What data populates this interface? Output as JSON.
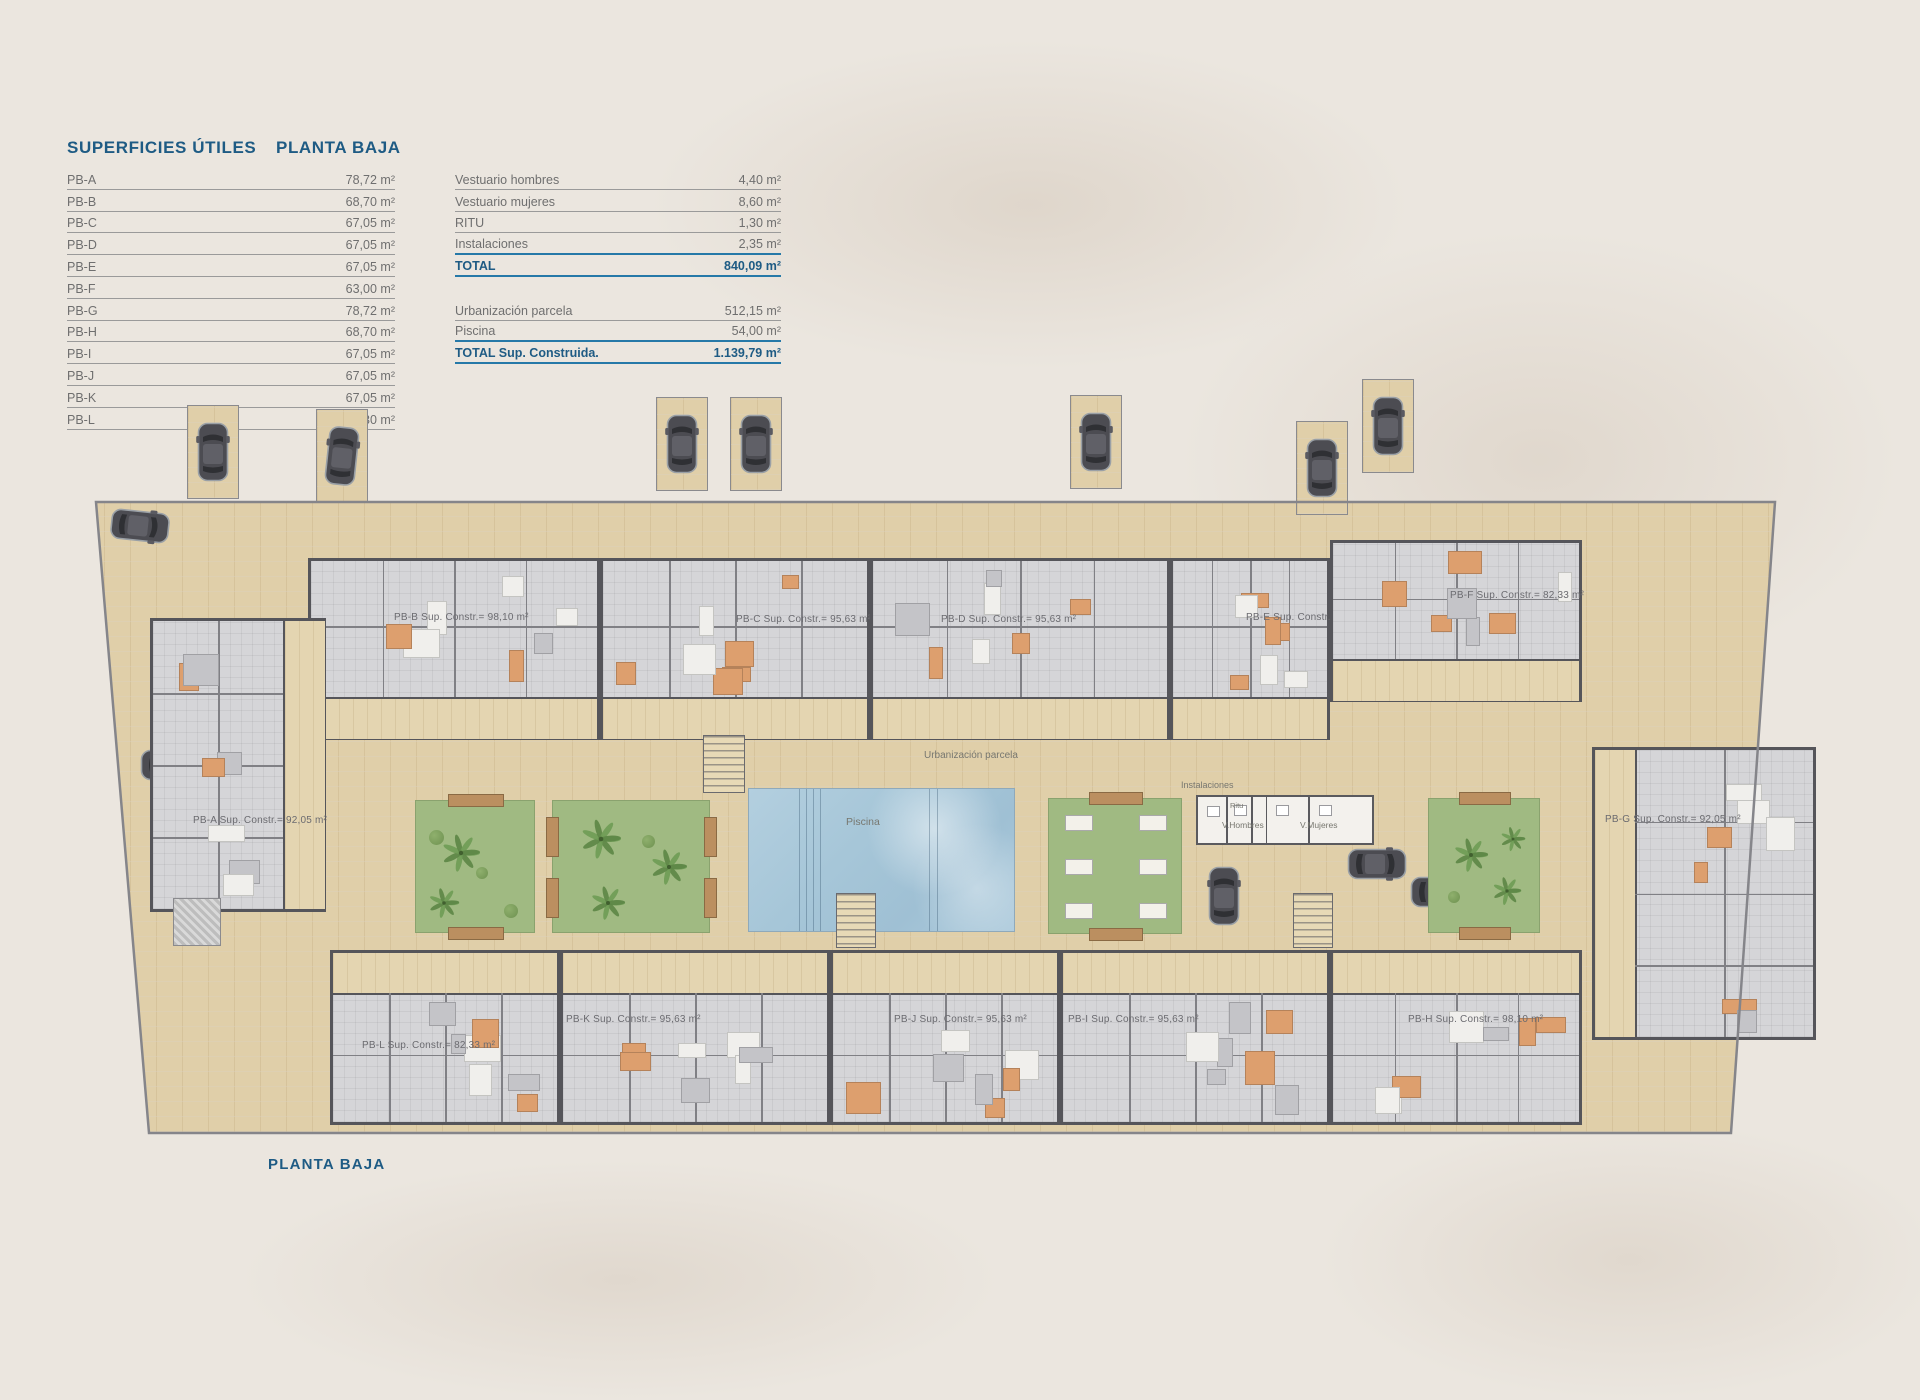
{
  "tables": {
    "title_main": "SUPERFICIES ÚTILES",
    "title_floor": "PLANTA BAJA",
    "unit_rows": [
      {
        "label": "PB-A",
        "value": "78,72 m²"
      },
      {
        "label": "PB-B",
        "value": "68,70 m²"
      },
      {
        "label": "PB-C",
        "value": "67,05 m²"
      },
      {
        "label": "PB-D",
        "value": "67,05 m²"
      },
      {
        "label": "PB-E",
        "value": "67,05 m²"
      },
      {
        "label": "PB-F",
        "value": "63,00 m²"
      },
      {
        "label": "PB-G",
        "value": "78,72 m²"
      },
      {
        "label": "PB-H",
        "value": "68,70 m²"
      },
      {
        "label": "PB-I",
        "value": "67,05 m²"
      },
      {
        "label": "PB-J",
        "value": "67,05 m²"
      },
      {
        "label": "PB-K",
        "value": "67,05 m²"
      },
      {
        "label": "PB-L",
        "value": "63,30 m²"
      }
    ],
    "summary_rows": [
      {
        "label": "Vestuario hombres",
        "value": "4,40 m²"
      },
      {
        "label": "Vestuario mujeres",
        "value": "8,60 m²"
      },
      {
        "label": "RITU",
        "value": "1,30 m²"
      },
      {
        "label": "Instalaciones",
        "value": "2,35 m²",
        "line": "blue"
      },
      {
        "label": "TOTAL",
        "value": "840,09 m²",
        "total": true,
        "line": "blue"
      },
      {
        "spacer": true
      },
      {
        "label": "Urbanización parcela",
        "value": "512,15 m²"
      },
      {
        "label": "Piscina",
        "value": "54,00 m²",
        "line": "blue"
      },
      {
        "label": "TOTAL Sup. Construida.",
        "value": "1.139,79 m²",
        "total": true,
        "line": "blue"
      }
    ]
  },
  "plan": {
    "caption": "PLANTA BAJA",
    "parcel": [
      [
        96,
        502
      ],
      [
        1775,
        502
      ],
      [
        1731,
        1133
      ],
      [
        149,
        1133
      ]
    ],
    "units": [
      {
        "id": "PB-B",
        "label": "PB-B Sup. Constr.= 98,10 m²",
        "x": 308,
        "y": 558,
        "w": 292,
        "h": 182,
        "patio": "bottom",
        "label_x": 394,
        "label_y": 612
      },
      {
        "id": "PB-C",
        "label": "PB-C Sup. Constr.= 95,63 m²",
        "x": 600,
        "y": 558,
        "w": 270,
        "h": 182,
        "patio": "bottom",
        "label_x": 736,
        "label_y": 614
      },
      {
        "id": "PB-D",
        "label": "PB-D Sup. Constr.= 95,63 m²",
        "x": 870,
        "y": 558,
        "w": 300,
        "h": 182,
        "patio": "bottom",
        "label_x": 941,
        "label_y": 614
      },
      {
        "id": "PB-E",
        "label": "PB-E Sup. Constr.= 95,63 m²",
        "x": 1170,
        "y": 558,
        "w": 160,
        "h": 182,
        "patio": "bottom",
        "label_x": 1246,
        "label_y": 612
      },
      {
        "id": "PB-F",
        "label": "PB-F Sup. Constr.= 82,33 m²",
        "x": 1330,
        "y": 540,
        "w": 252,
        "h": 162,
        "patio": "bottom",
        "label_x": 1450,
        "label_y": 590
      },
      {
        "id": "PB-A",
        "label": "PB-A Sup. Constr.= 92,05 m²",
        "x": 150,
        "y": 618,
        "w": 176,
        "h": 294,
        "patio": "right",
        "label_x": 193,
        "label_y": 815
      },
      {
        "id": "PB-G",
        "label": "PB-G Sup. Constr.= 92,05 m²",
        "x": 1592,
        "y": 747,
        "w": 224,
        "h": 293,
        "patio": "left",
        "label_x": 1605,
        "label_y": 814
      },
      {
        "id": "PB-L",
        "label": "PB-L Sup. Constr.= 82,33 m²",
        "x": 330,
        "y": 950,
        "w": 230,
        "h": 175,
        "patio": "top",
        "label_x": 362,
        "label_y": 1040
      },
      {
        "id": "PB-K",
        "label": "PB-K Sup. Constr.= 95,63 m²",
        "x": 560,
        "y": 950,
        "w": 270,
        "h": 175,
        "patio": "top",
        "label_x": 566,
        "label_y": 1014
      },
      {
        "id": "PB-J",
        "label": "PB-J Sup. Constr.= 95,63 m²",
        "x": 830,
        "y": 950,
        "w": 230,
        "h": 175,
        "patio": "top",
        "label_x": 894,
        "label_y": 1014
      },
      {
        "id": "PB-I",
        "label": "PB-I Sup. Constr.= 95,63 m²",
        "x": 1060,
        "y": 950,
        "w": 270,
        "h": 175,
        "patio": "top",
        "label_x": 1068,
        "label_y": 1014
      },
      {
        "id": "PB-H",
        "label": "PB-H Sup. Constr.= 98,10 m²",
        "x": 1330,
        "y": 950,
        "w": 252,
        "h": 175,
        "patio": "top",
        "label_x": 1408,
        "label_y": 1014
      }
    ],
    "labels": {
      "urbanizacion": {
        "text": "Urbanización parcela",
        "x": 924,
        "y": 750,
        "size": 10
      },
      "piscina": {
        "text": "Piscina",
        "x": 846,
        "y": 816,
        "size": 10.5
      },
      "instalaciones": {
        "text": "Instalaciones",
        "x": 1181,
        "y": 780,
        "size": 9
      },
      "ritu": {
        "text": "Ritu",
        "x": 1230,
        "y": 801,
        "size": 7.5
      },
      "v_hombres": {
        "text": "V.Hombres",
        "x": 1222,
        "y": 820,
        "size": 8.5
      },
      "v_mujeres": {
        "text": "V.Mujeres",
        "x": 1300,
        "y": 820,
        "size": 8.5
      }
    },
    "pool": {
      "x": 748,
      "y": 788,
      "w": 267,
      "h": 144,
      "lanes": [
        50,
        57,
        64,
        71,
        180,
        188
      ]
    },
    "gardens": [
      {
        "x": 415,
        "y": 800,
        "w": 120,
        "h": 133,
        "planters": "h",
        "palms": [
          [
            45,
            52,
            40
          ],
          [
            28,
            102,
            32
          ]
        ],
        "bushes": [
          [
            20,
            36,
            15
          ],
          [
            66,
            72,
            12
          ],
          [
            95,
            110,
            14
          ]
        ]
      },
      {
        "x": 552,
        "y": 800,
        "w": 158,
        "h": 133,
        "planters": "v",
        "palms": [
          [
            48,
            38,
            42
          ],
          [
            55,
            102,
            36
          ],
          [
            116,
            66,
            38
          ]
        ],
        "bushes": [
          [
            95,
            40,
            13
          ]
        ]
      },
      {
        "x": 1428,
        "y": 798,
        "w": 112,
        "h": 135,
        "planters": "h",
        "palms": [
          [
            42,
            56,
            36
          ],
          [
            78,
            92,
            30
          ],
          [
            84,
            40,
            26
          ]
        ],
        "bushes": [
          [
            25,
            98,
            12
          ]
        ]
      }
    ],
    "pergola": {
      "x": 1048,
      "y": 798,
      "w": 134,
      "h": 136,
      "rows": 3,
      "cols": 2
    },
    "instal": {
      "x": 1196,
      "y": 795,
      "w": 178,
      "h": 50,
      "walls": [
        0.16,
        0.3,
        0.38,
        0.62
      ]
    },
    "stairs": [
      [
        703,
        735,
        42,
        58
      ],
      [
        836,
        893,
        40,
        55
      ],
      [
        1293,
        893,
        40,
        55
      ]
    ],
    "hatch_boxes": [
      [
        173,
        898,
        46,
        46
      ]
    ],
    "cars": [
      {
        "x": 213,
        "y": 452,
        "r": 0,
        "bay": true
      },
      {
        "x": 342,
        "y": 456,
        "r": 6,
        "bay": true
      },
      {
        "x": 140,
        "y": 526,
        "r": 96,
        "bay": false
      },
      {
        "x": 682,
        "y": 444,
        "r": 0,
        "bay": true
      },
      {
        "x": 756,
        "y": 444,
        "r": 0,
        "bay": true
      },
      {
        "x": 1096,
        "y": 442,
        "r": 0,
        "bay": true
      },
      {
        "x": 1322,
        "y": 468,
        "r": 0,
        "bay": true
      },
      {
        "x": 1388,
        "y": 426,
        "r": 0,
        "bay": true
      },
      {
        "x": 1360,
        "y": 578,
        "r": 90,
        "bay": false
      },
      {
        "x": 170,
        "y": 765,
        "r": 90,
        "bay": false
      },
      {
        "x": 237,
        "y": 864,
        "r": 0,
        "bay": false
      },
      {
        "x": 470,
        "y": 902,
        "r": 0,
        "bay": false
      },
      {
        "x": 816,
        "y": 892,
        "r": 0,
        "bay": false
      },
      {
        "x": 893,
        "y": 902,
        "r": 0,
        "bay": false
      },
      {
        "x": 1224,
        "y": 896,
        "r": 0,
        "bay": false
      },
      {
        "x": 1377,
        "y": 864,
        "r": 90,
        "bay": false
      },
      {
        "x": 1440,
        "y": 892,
        "r": 90,
        "bay": false
      }
    ]
  },
  "colors": {
    "accent_blue": "#1e5b84",
    "line_blue": "#2679a8",
    "paving": "#e0cfa9",
    "pool_blue": "#a6c6d8",
    "garden_green": "#a0ba82",
    "wall_gray": "#55555a"
  }
}
